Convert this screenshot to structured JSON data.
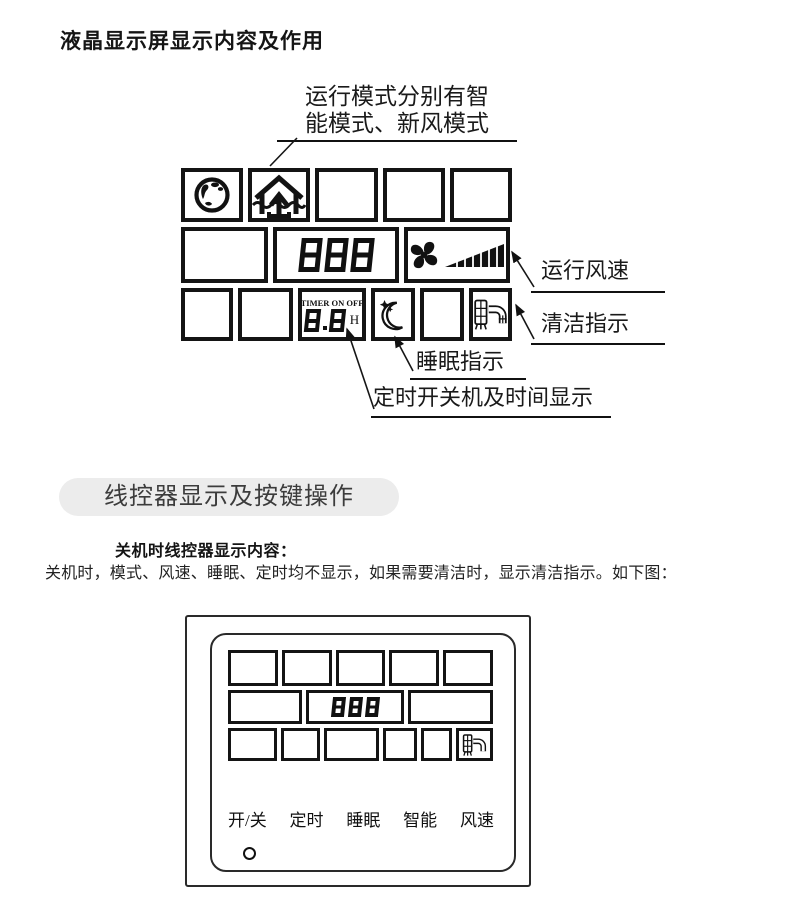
{
  "page": {
    "title": "液晶显示屏显示内容及作用"
  },
  "colors": {
    "ink": "#111111",
    "pill_bg": "#ececec",
    "pill_text": "#3c3c3c"
  },
  "lcd_diagram": {
    "mode_note": {
      "line1": "运行模式分别有智",
      "line2": "能模式、新风模式"
    },
    "labels": {
      "fan_speed": "运行风速",
      "clean": "清洁指示",
      "sleep": "睡眠指示",
      "timer": "定时开关机及时间显示"
    },
    "display": {
      "digits": "888",
      "timer_title": "TIMER ON OFF",
      "timer_digits": "8.8",
      "timer_unit": "H"
    },
    "icons": {
      "mode_smart": "globe-icon",
      "mode_fresh_air": "fresh-air-house-icon",
      "fan": "fan-icon",
      "fan_speed_bars": "speed-wedge-icon",
      "sleep": "moon-stars-icon",
      "clean": "filter-clean-icon"
    }
  },
  "section": {
    "header": "线控器显示及按键操作",
    "subheading": "关机时线控器显示内容：",
    "body": "关机时，模式、风速、睡眠、定时均不显示，如果需要清洁时，显示清洁指示。如下图："
  },
  "controller": {
    "display_digits": "888",
    "clean_icon": "filter-clean-icon",
    "buttons": [
      "开/关",
      "定时",
      "睡眠",
      "智能",
      "风速"
    ],
    "power_led": "indicator-dot"
  }
}
